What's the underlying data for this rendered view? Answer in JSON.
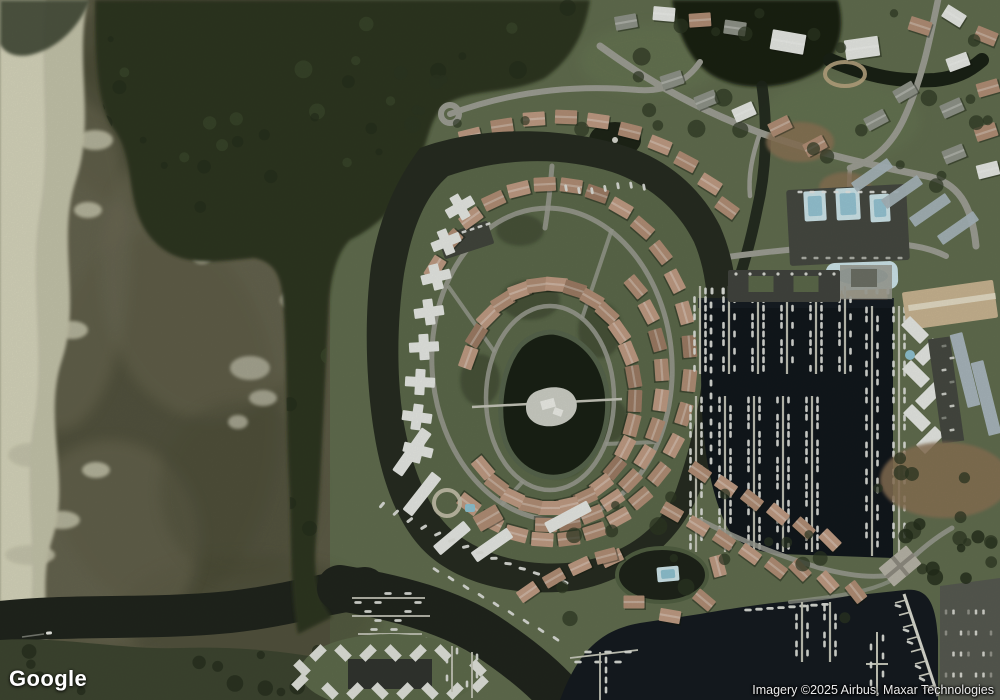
{
  "branding": {
    "logo_text": "Google"
  },
  "attribution": {
    "text": "Imagery ©2025 Airbus, Maxar Technologies"
  },
  "scene_regions": [
    "tidal-marsh",
    "mangrove-forest",
    "circular-canal-community",
    "central-pond-island",
    "marina-with-docks",
    "suburban-streets",
    "boat-basin"
  ],
  "palette": {
    "marsh": "#5b5944",
    "marshDark": "#474633",
    "marshLight": "#6e6b54",
    "sand": "#c6c4ab",
    "sandLight": "#dad8c0",
    "forest": "#2a331f",
    "forestDark": "#1f2817",
    "forestLight": "#3c4a2b",
    "suburbGreen": "#5f6b4c",
    "lawnLight": "#6a7852",
    "islandGreen": "#5a6748",
    "lawnDark": "#3a422d",
    "canal": "#23281d",
    "channel": "#1c2019",
    "marina": "#0d1218",
    "pond": "#161c11",
    "basin": "#11161c",
    "road": "#9d9e94",
    "roofTan": "#b28d74",
    "roofSalmon": "#c09a82",
    "roofBrown": "#9c7a63",
    "roofWhite": "#e9eae6",
    "roofGray": "#8f9288",
    "roofBlueGray": "#a9b6bd",
    "dock": "#c9c9bc",
    "boat": "#e2e3dd",
    "pool": "#8fc2d2",
    "poolLight": "#cfe6ed",
    "asphalt": "#43453e",
    "dirt": "#8a6f52"
  }
}
